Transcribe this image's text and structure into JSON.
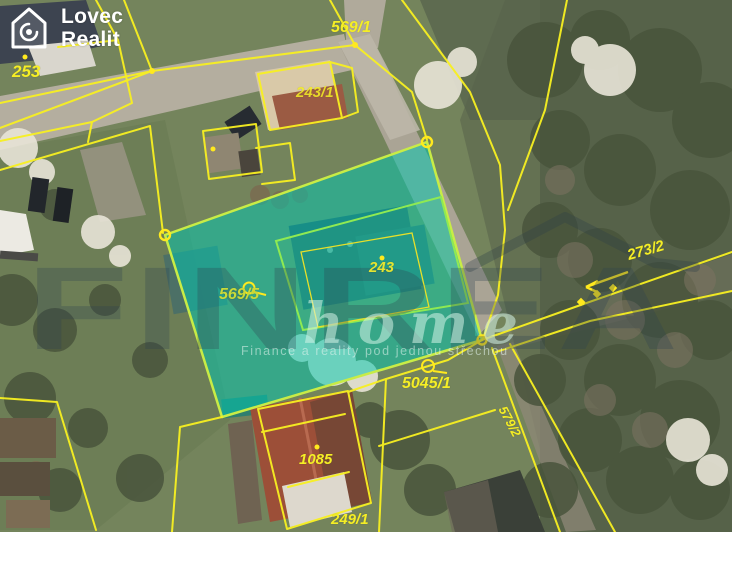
{
  "logo": {
    "name": "Lovec Realit",
    "line1": "Lovec",
    "line2": "Realit",
    "icon": "house-spiral-icon"
  },
  "watermark": {
    "brand": "FINREA",
    "sub": "home",
    "slogan": "Finance a reality pod jednou střechou"
  },
  "parcels": {
    "p253": {
      "label": "253"
    },
    "p569_1": {
      "label": "569/1"
    },
    "p243_1": {
      "label": "243/1"
    },
    "p243": {
      "label": "243"
    },
    "p569_5": {
      "label": "569/5"
    },
    "p273_2": {
      "label": "273/2"
    },
    "p5045_1": {
      "label": "5045/1"
    },
    "p579_2": {
      "label": "579/2"
    },
    "p1085": {
      "label": "1085"
    },
    "p249_1": {
      "label": "249/1"
    }
  },
  "highlight": {
    "description": "selected parcel overlay",
    "fill": "#00c8b0",
    "border": "#c8ec46"
  },
  "colors": {
    "cadastral_line": "#f8f021",
    "marker_yellow": "#ffe91e",
    "label_yellow": "#f5ee26",
    "label_green": "#c9da3a",
    "logo_white": "#ffffff",
    "watermark_dark": "#30424e"
  },
  "map": {
    "type": "aerial-cadastral-view"
  }
}
